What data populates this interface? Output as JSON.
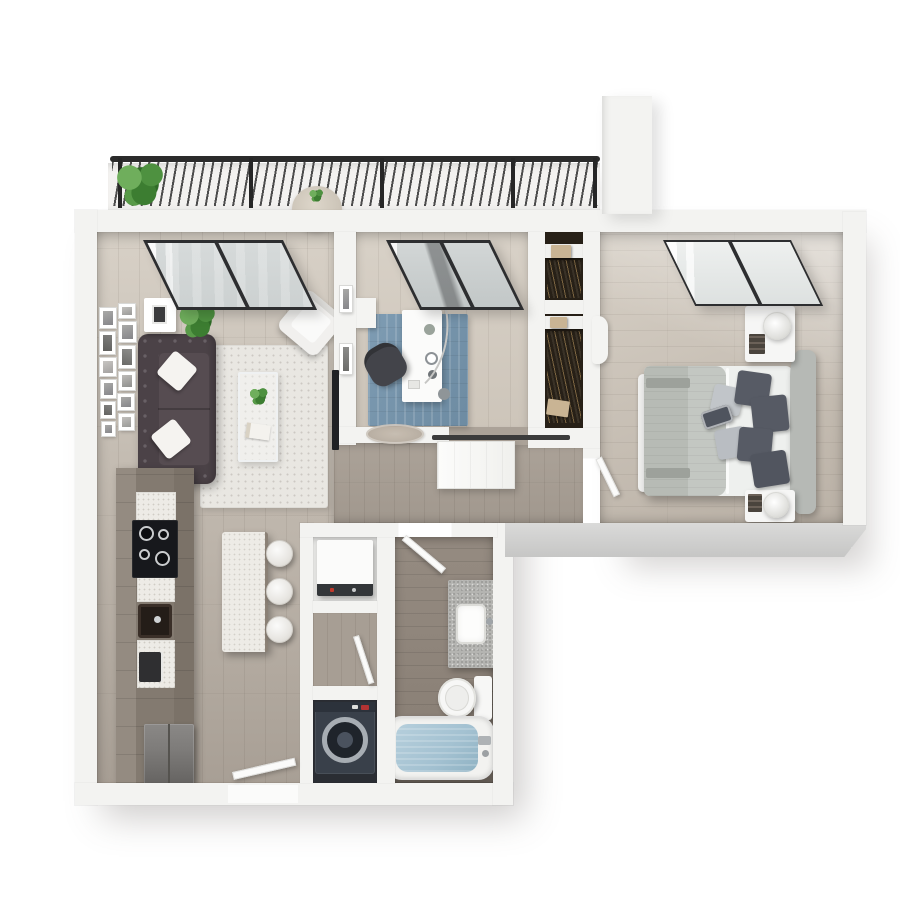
{
  "scene": {
    "type": "3d-floor-plan-render",
    "description": "Top-down 3D rendering of a one/two-bedroom apartment floor plan with balcony",
    "background": "#ffffff"
  },
  "colors": {
    "bg": "#ffffff",
    "wall": "#f3f3f1",
    "wallFace": "#c6c6c5",
    "floorLight": "#d8d1c7",
    "floorMid": "#c2bab0",
    "floorDark": "#a89f95",
    "floorBedLight": "#d7d0c6",
    "floorBedDark": "#bab1a6",
    "floorBath": "#958b81",
    "floorHall": "#aba298",
    "balconyFloor": "#f3f2f0",
    "railing": "#2b2b2b",
    "glass": "#ccd1d1",
    "frame": "#2d2e30",
    "rugLiving": "#e9e7e2",
    "rugOffice": "#7e9cb3",
    "sofa": "#4b4247",
    "pillow": "#f5f3f0",
    "plantA": "#6fae5c",
    "plantB": "#3c7d31",
    "cabinet": "#837a70",
    "counterWhite": "#edebe6",
    "cooktop": "#17181c",
    "fridge": "#7e7c7a",
    "washer": "#39404a",
    "washerRing": "#a7adb3",
    "appliance": "#fbfbfa",
    "tub": "#f2f2f0",
    "water": "#a3c1d1",
    "granite": "#b4b4b1",
    "white": "#f7f7f6",
    "sheet": "#eef0ee",
    "duvet": "#c3c7c2",
    "throwBand": "#9da19b",
    "pillowDark": "#575b65",
    "pillowLight": "#c1c5c9",
    "headboard": "#b6b9b5",
    "nightstand": "#f6f6f5",
    "closetDark": "#272017",
    "closetBox": "#c9b494",
    "door": "#fbfbfa",
    "barnRail": "#3b3b3b",
    "tv": "#202124",
    "chair": "#43444a",
    "medallion": "#b3a89b"
  },
  "balcony": {
    "elements": [
      "metal-railing",
      "slanted-balusters",
      "railing-posts",
      "palm-planter",
      "bistro-table",
      "table-plant"
    ]
  },
  "rooms": [
    {
      "id": "living-room",
      "floor": "light-oak-planks",
      "furniture": [
        "tufted-sofa",
        "white-throw-pillows",
        "shag-area-rug",
        "glass-coffee-table",
        "table-plant",
        "book",
        "accent-armchair",
        "gallery-wall-frames",
        "wall-cube-shelf",
        "potted-plant",
        "wall-mounted-tv",
        "double-window"
      ]
    },
    {
      "id": "den-office",
      "floor": "light-oak-planks",
      "furniture": [
        "white-desk",
        "desk-chair",
        "arc-floor-lamp",
        "blue-area-rug",
        "sliding-glass-balcony-door",
        "sliding-barn-door",
        "wall-frames",
        "wall-medallion",
        "desk-accessories"
      ]
    },
    {
      "id": "walk-in-closet",
      "furniture": [
        "upper-shelf",
        "lower-shelf",
        "storage-boxes",
        "hanging-clothes"
      ]
    },
    {
      "id": "bedroom",
      "floor": "oak-planks",
      "furniture": [
        "platform-bed",
        "gray-duvet",
        "textured-throw",
        "dark-accent-pillows",
        "light-pillows",
        "striped-lumbar-pillow",
        "curved-upholstered-headboard",
        "nightstand-north",
        "nightstand-south",
        "sphere-table-lamps",
        "book-stacks",
        "foot-bench",
        "scalloped-wall-decor",
        "double-window"
      ]
    },
    {
      "id": "kitchen",
      "furniture": [
        "cabinet-run",
        "white-quartz-counters",
        "four-burner-cooktop",
        "undermount-sink",
        "coffee-maker",
        "refrigerator",
        "quartz-island",
        "three-bar-stools"
      ]
    },
    {
      "id": "bathroom",
      "furniture": [
        "granite-vanity",
        "basin-sink",
        "faucet",
        "toilet",
        "soaking-tub",
        "tub-faucet"
      ]
    },
    {
      "id": "laundry-utility",
      "furniture": [
        "stacked-white-appliance",
        "front-load-washer",
        "storage-alcove"
      ]
    },
    {
      "id": "hallway",
      "furniture": []
    }
  ],
  "doors": [
    {
      "id": "entry-door",
      "type": "swing",
      "location": "bottom-wall"
    },
    {
      "id": "bathroom-door",
      "type": "swing",
      "location": "bathroom-top-wall"
    },
    {
      "id": "bedroom-door",
      "type": "swing",
      "location": "bedroom-left-wall"
    },
    {
      "id": "utility-door",
      "type": "swing",
      "location": "laundry-alcove"
    },
    {
      "id": "office-barn-door",
      "type": "sliding",
      "location": "office-south-wall"
    }
  ],
  "windows": [
    "living-room-double-window",
    "office-sliding-glass-door",
    "bedroom-double-window"
  ]
}
